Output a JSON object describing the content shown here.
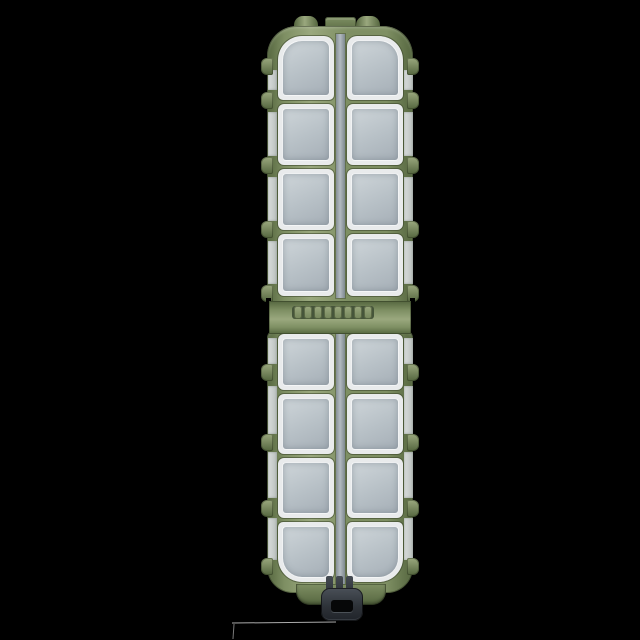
{
  "meta": {
    "description": "Product photo of a closed olive-green plastic fishing tackle box with frosted clear compartment lids, photographed on a black background"
  },
  "product": {
    "name": "compartment-tackle-box",
    "halves": [
      {
        "name": "top",
        "rows": 4,
        "cols": 2,
        "compartments": 8
      },
      {
        "name": "bottom",
        "rows": 4,
        "cols": 2,
        "compartments": 8
      }
    ],
    "total_compartments": 16,
    "hinge": {
      "knuckles": 8
    },
    "latch": {
      "style": "buckle",
      "prongs": 3
    },
    "side_tabs_per_side": 9,
    "top_tabs": 3
  },
  "colors": {
    "background": "#000000",
    "shell_green": "#7e8f63",
    "shell_green_dark": "#55663f",
    "shell_green_light": "#9aa87e",
    "lid_rim": "#e9ebec",
    "lid_pane": "#b7c0c6",
    "lid_pane_light": "#ced5d9",
    "divider_strip": "#b3bac0",
    "latch_dark": "#2e3339",
    "latch_hole": "#060708",
    "floor_line": "#c9c9c9"
  }
}
